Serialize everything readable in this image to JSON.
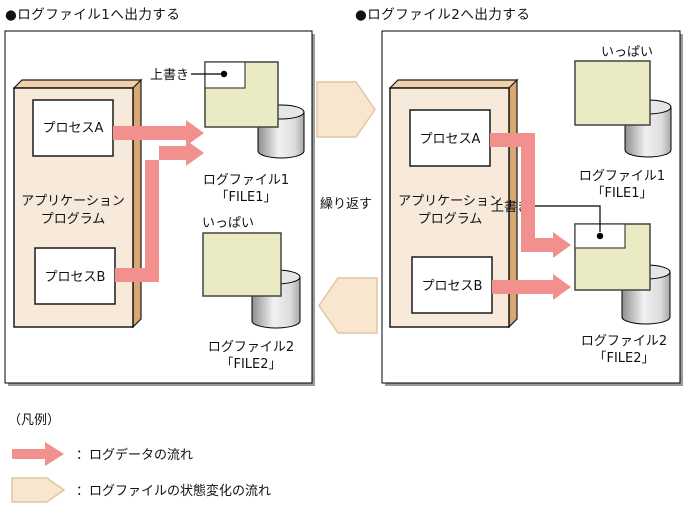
{
  "titles": {
    "left": "●ログファイル1へ出力する",
    "right": "●ログファイル2へ出力する"
  },
  "left_panel": {
    "app_program_line1": "アプリケーション",
    "app_program_line2": "プログラム",
    "process_a": "プロセスA",
    "process_b": "プロセスB",
    "overwrite_label": "上書き",
    "full_label": "いっぱい",
    "logfile1_name": "ログファイル1",
    "logfile1_file": "「FILE1」",
    "logfile2_name": "ログファイル2",
    "logfile2_file": "「FILE2」"
  },
  "right_panel": {
    "app_program_line1": "アプリケーション",
    "app_program_line2": "プログラム",
    "process_a": "プロセスA",
    "process_b": "プロセスB",
    "overwrite_label": "上書き",
    "full_label": "いっぱい",
    "logfile1_name": "ログファイル1",
    "logfile1_file": "「FILE1」",
    "logfile2_name": "ログファイル2",
    "logfile2_file": "「FILE2」"
  },
  "between_panels": {
    "repeat_label": "繰り返す"
  },
  "legend": {
    "heading": "（凡例）",
    "data_flow_label": "：ログデータの流れ",
    "state_flow_label": "：ログファイルの状態変化の流れ"
  },
  "colors": {
    "data_flow_pink": "#F2908E",
    "state_flow_beige": "#F9E6CE",
    "state_flow_border": "#E2C6A2",
    "logfile_yellow": "#EBEBC3",
    "app_box_front": "#F8EADB",
    "app_box_side": "#D8A772",
    "app_box_top": "#EFD2AA"
  }
}
